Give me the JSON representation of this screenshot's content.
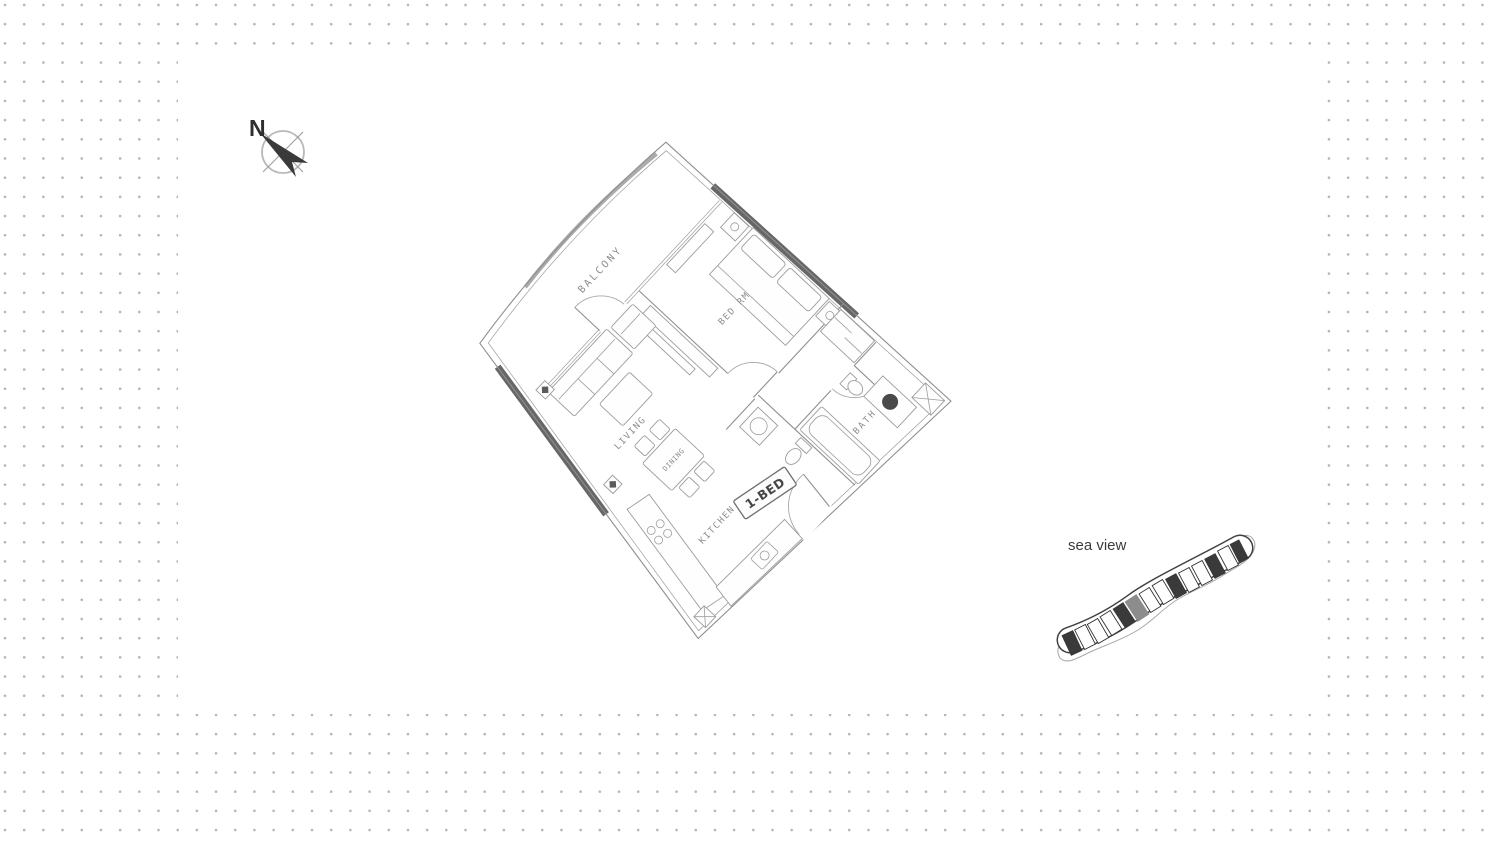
{
  "page": {
    "background": "#ffffff",
    "dot_color": "#b4b4b4"
  },
  "compass": {
    "label": "N"
  },
  "floor_plan": {
    "unit_label": "1-BED",
    "rooms": {
      "balcony": "BALCONY",
      "bedroom": "BED RM",
      "living": "LIVING",
      "dining": "DINING",
      "kitchen": "KITCHEN",
      "bath": "BATH"
    }
  },
  "key_plan": {
    "caption": "sea view",
    "highlight_color": "#8c8c8c"
  }
}
